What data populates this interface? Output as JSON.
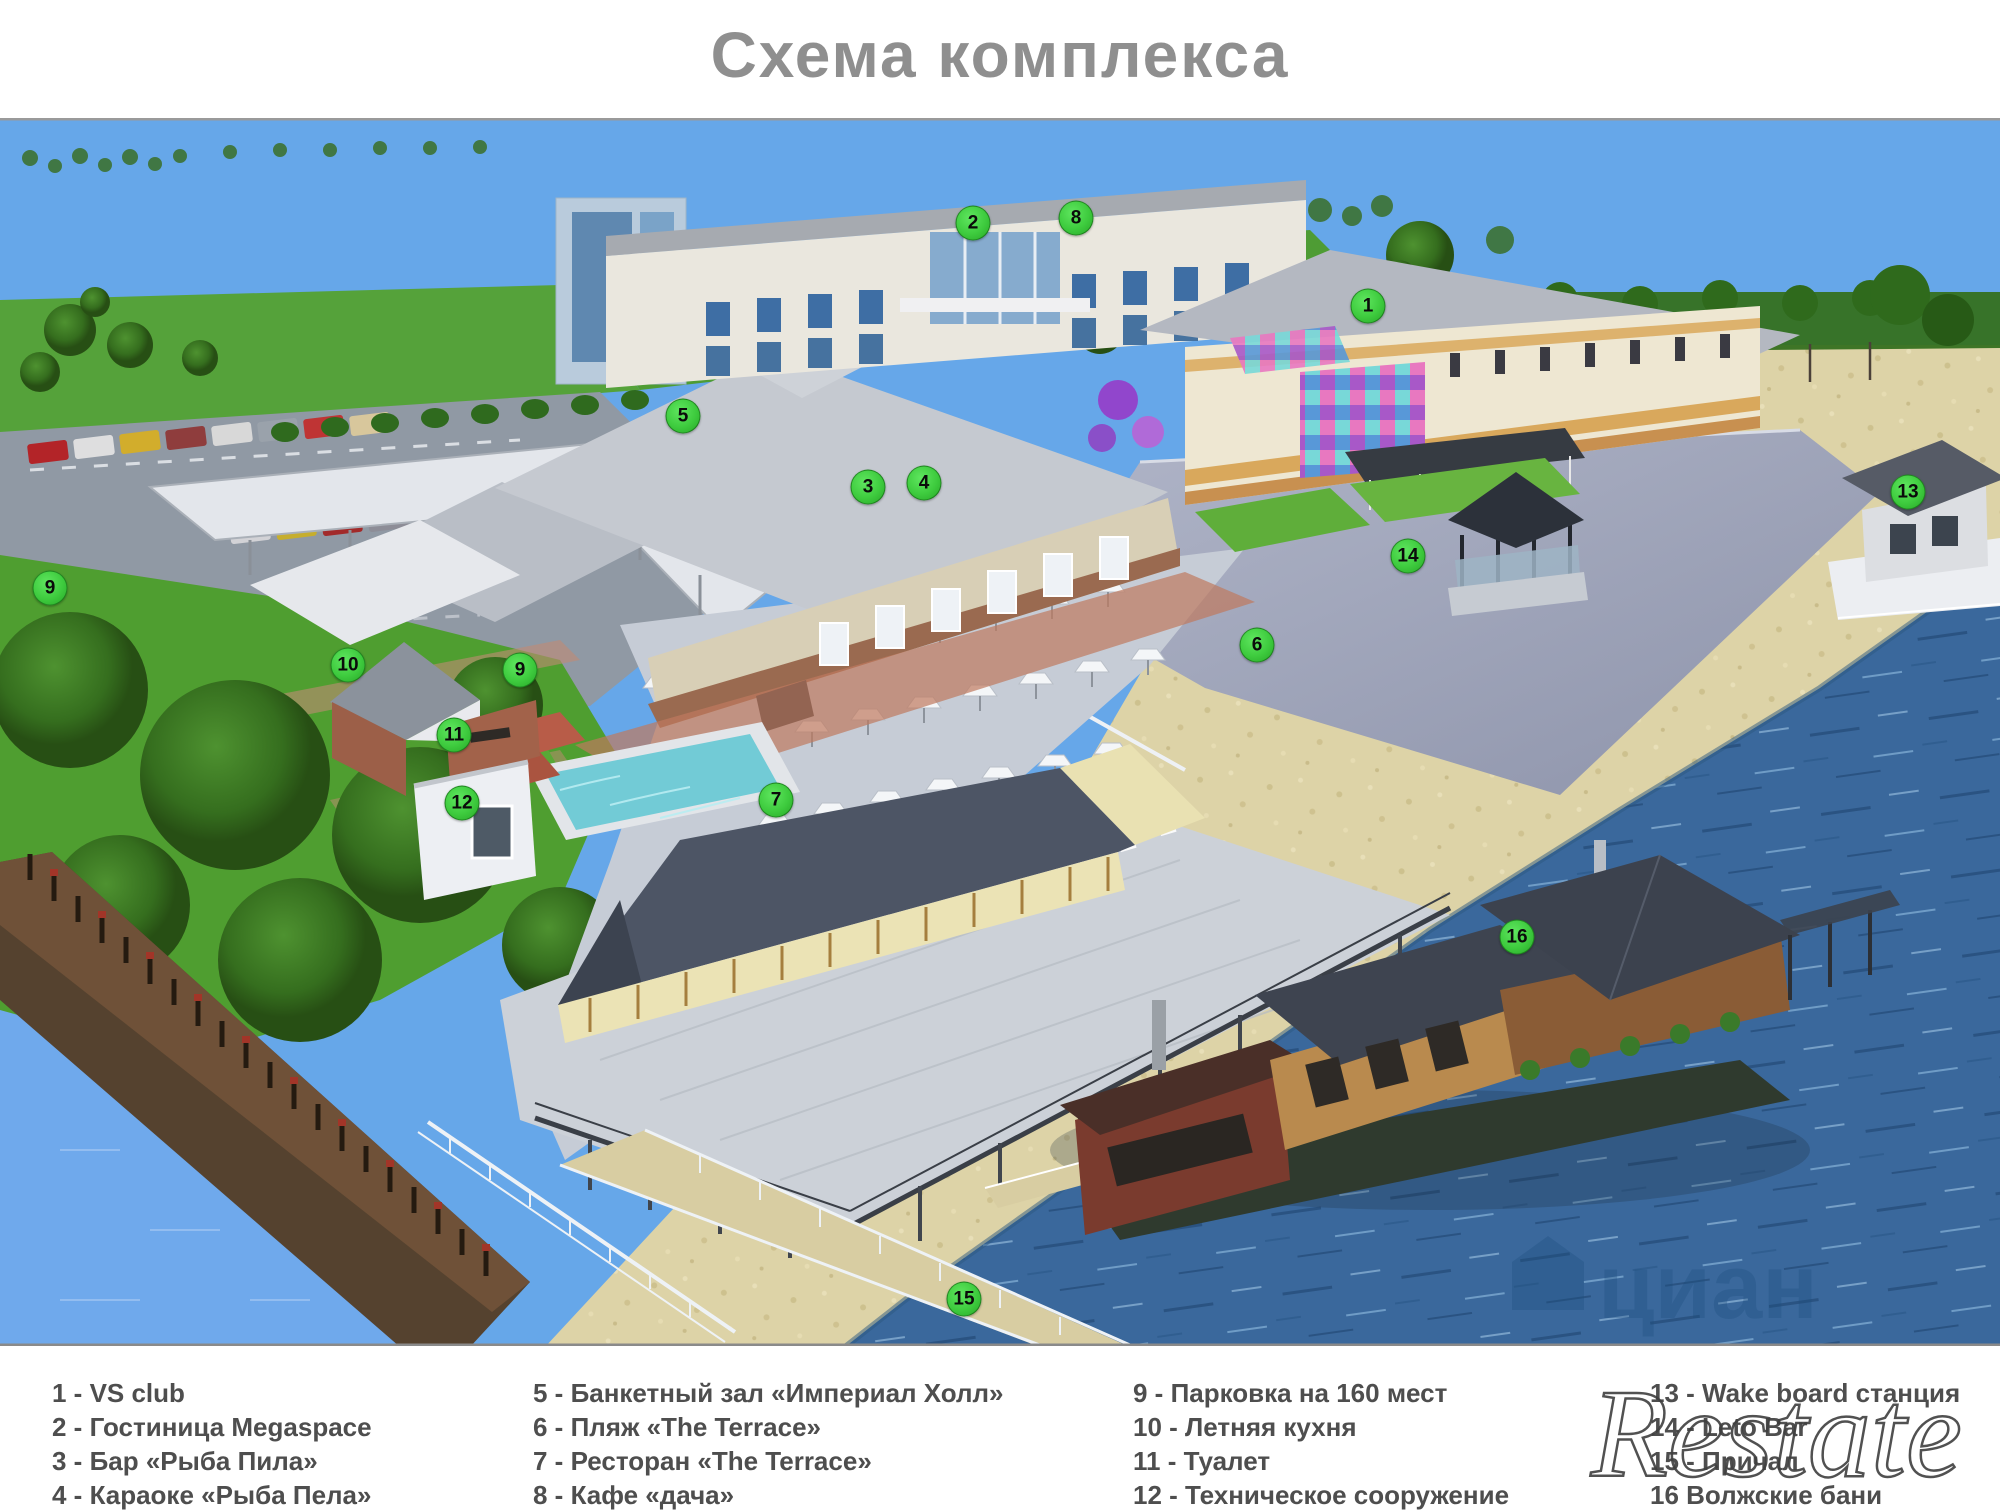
{
  "title": "Схема комплекса",
  "legend": {
    "columns": [
      {
        "items": [
          "1  - VS club",
          "2 - Гостиница Megaspace",
          "3 - Бар «Рыба Пила»",
          "4 - Караоке «Рыба Пела»"
        ]
      },
      {
        "items": [
          "5 - Банкетный зал «Империал Холл»",
          "6 - Пляж «The Terrace»",
          "7 - Ресторан «The Terrace»",
          "8 - Кафе «дача»"
        ]
      },
      {
        "items": [
          "9 - Парковка на 160  мест",
          "10 - Летняя кухня",
          "11 - Туалет",
          "12 - Техническое сооружение"
        ]
      },
      {
        "items": [
          "13 - Wake board станция",
          "14 - Leto Bar",
          "15 - Причал",
          "16 Волжские бани"
        ]
      }
    ]
  },
  "markers": [
    {
      "n": "1",
      "x": 1368,
      "y": 306
    },
    {
      "n": "2",
      "x": 973,
      "y": 223
    },
    {
      "n": "3",
      "x": 868,
      "y": 487
    },
    {
      "n": "4",
      "x": 924,
      "y": 483
    },
    {
      "n": "5",
      "x": 683,
      "y": 416
    },
    {
      "n": "6",
      "x": 1257,
      "y": 645
    },
    {
      "n": "7",
      "x": 776,
      "y": 800
    },
    {
      "n": "8",
      "x": 1076,
      "y": 218
    },
    {
      "n": "9",
      "x": 50,
      "y": 588
    },
    {
      "n": "9",
      "x": 520,
      "y": 670
    },
    {
      "n": "10",
      "x": 348,
      "y": 665
    },
    {
      "n": "11",
      "x": 454,
      "y": 735
    },
    {
      "n": "12",
      "x": 462,
      "y": 803
    },
    {
      "n": "13",
      "x": 1908,
      "y": 492
    },
    {
      "n": "14",
      "x": 1408,
      "y": 556
    },
    {
      "n": "15",
      "x": 964,
      "y": 1299
    },
    {
      "n": "16",
      "x": 1517,
      "y": 937
    }
  ],
  "watermarks": {
    "restate": "Restate",
    "cian": "циан"
  },
  "colors": {
    "marker_green": "#3ecb3e",
    "sky": "#66a7e9",
    "water": "#3a689c",
    "sand": "#ddd3a7",
    "grass": "#4f9e30",
    "title_gray": "#8f8f8f",
    "legend_text": "#4e4e4e"
  }
}
